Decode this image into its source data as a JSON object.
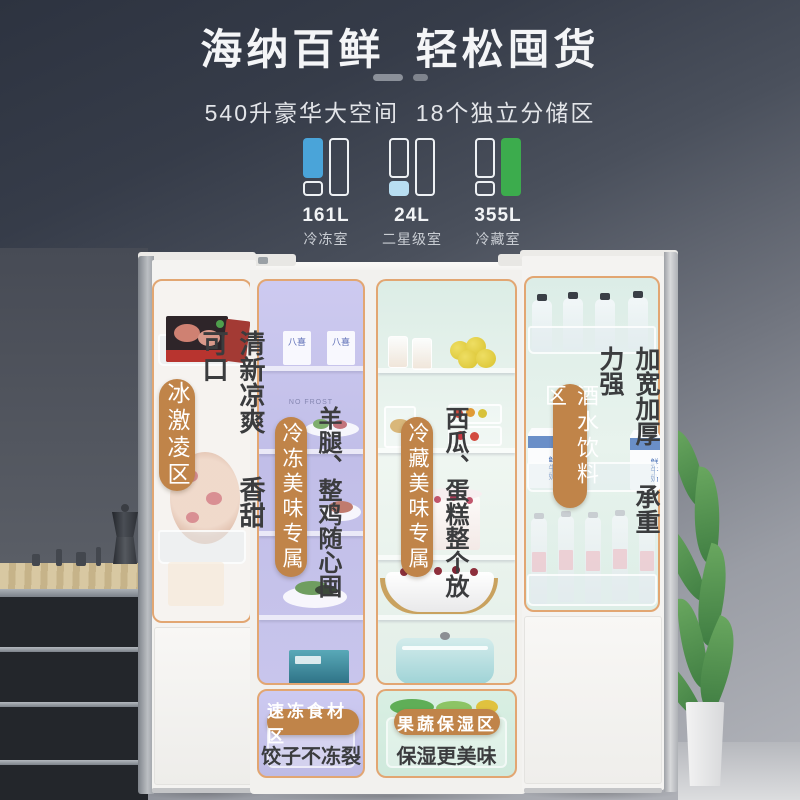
{
  "header": {
    "title": "海纳百鲜  轻松囤货",
    "subtitle": "540升豪华大空间  18个独立分储区"
  },
  "capacity": {
    "items": [
      {
        "value": "161L",
        "label": "冷冻室",
        "highlight": "left-tall",
        "color": "#4aa4d9"
      },
      {
        "value": "24L",
        "label": "二星级室",
        "highlight": "left-bottom",
        "color": "#b8def2"
      },
      {
        "value": "355L",
        "label": "冷藏室",
        "highlight": "right-tall",
        "color": "#3cac4d"
      }
    ]
  },
  "zones": {
    "ice_cream": {
      "name": "冰激凌区",
      "desc": "清新凉爽 香甜可口"
    },
    "freezer": {
      "name": "冷冻美味专属",
      "desc": "羊腿、整鸡随心囤"
    },
    "fridge": {
      "name": "冷藏美味专属",
      "desc": "西瓜、蛋糕整个放"
    },
    "drinks": {
      "name": "酒水饮料区",
      "desc": "加宽加厚 承重力强"
    },
    "quick_freeze": {
      "name": "速冻食材区",
      "desc": "饺子不冻裂"
    },
    "crisper": {
      "name": "果蔬保湿区",
      "desc": "保湿更美味"
    }
  },
  "photo_labels": {
    "ice_cream_brand": "八喜",
    "no_frost": "NO FROST",
    "milk": "鲜牛奶"
  },
  "colors": {
    "accent_pill": "#c08449",
    "zone_border": "#e2a672",
    "freezer_overlay": "#c6c3ea",
    "fridge_overlay": "#ddeee6",
    "icon_blue": "#4aa4d9",
    "icon_light_blue": "#b8def2",
    "icon_green": "#3cac4d",
    "title_text": "#f4f5f7",
    "desc_text": "#3b3c3e"
  }
}
